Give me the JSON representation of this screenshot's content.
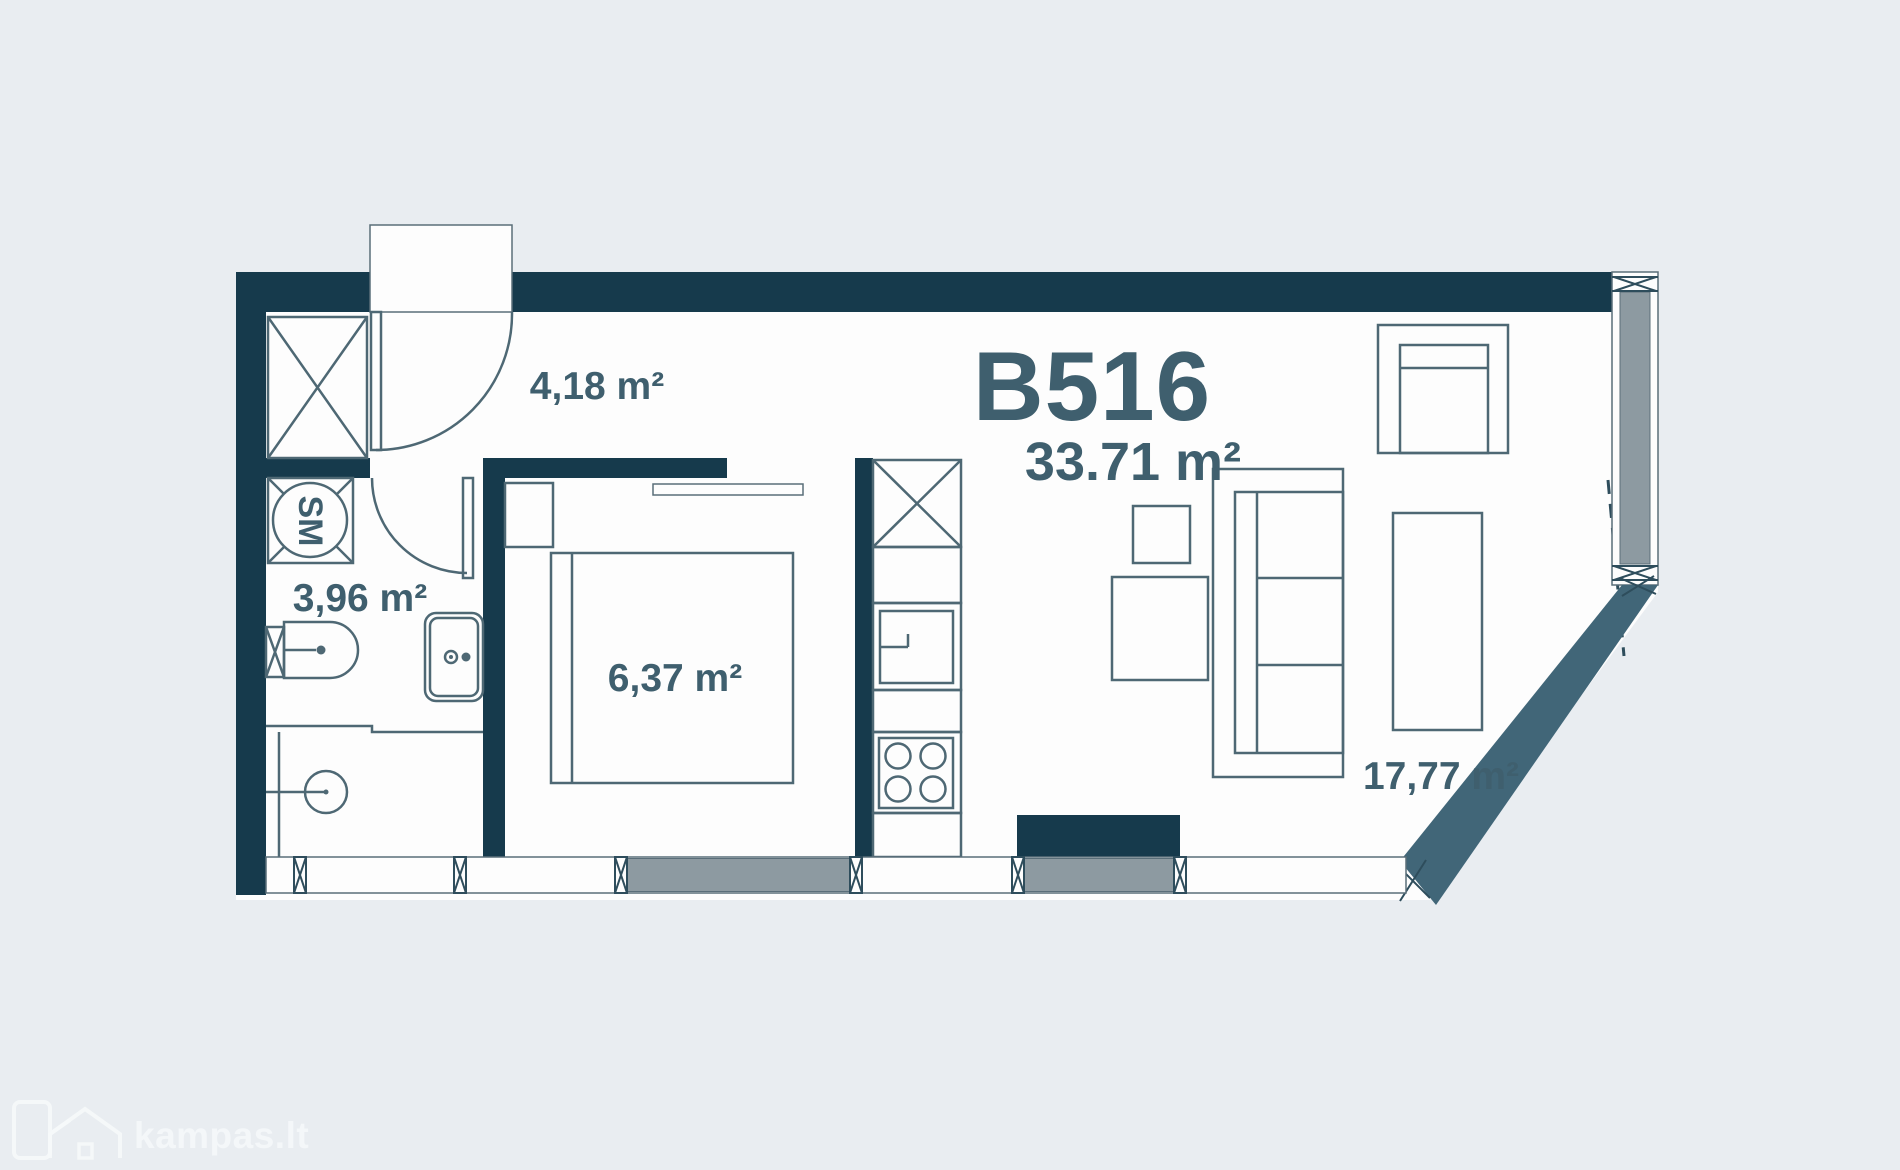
{
  "plan": {
    "unit_id": "B516",
    "total_area": "33.71 m²",
    "rooms": [
      {
        "name": "hallway",
        "area": "4,18 m²"
      },
      {
        "name": "bathroom",
        "area": "3,96 m²"
      },
      {
        "name": "bedroom",
        "area": "6,37 m²"
      },
      {
        "name": "living-kitchen",
        "area": "17,77 m²"
      }
    ],
    "labels": {
      "washing_machine": "SM"
    }
  },
  "watermark": {
    "brand": "kampas.lt"
  },
  "colors": {
    "background": "#e9edf1",
    "floor": "#fdfdfd",
    "wall": "#163a4c",
    "diagonal_wall": "#416678",
    "window_gray": "#8d9aa1",
    "accent_text": "#3f5f6e",
    "furniture_stroke": "#4e6874",
    "watermark": "#f5f8fa"
  }
}
